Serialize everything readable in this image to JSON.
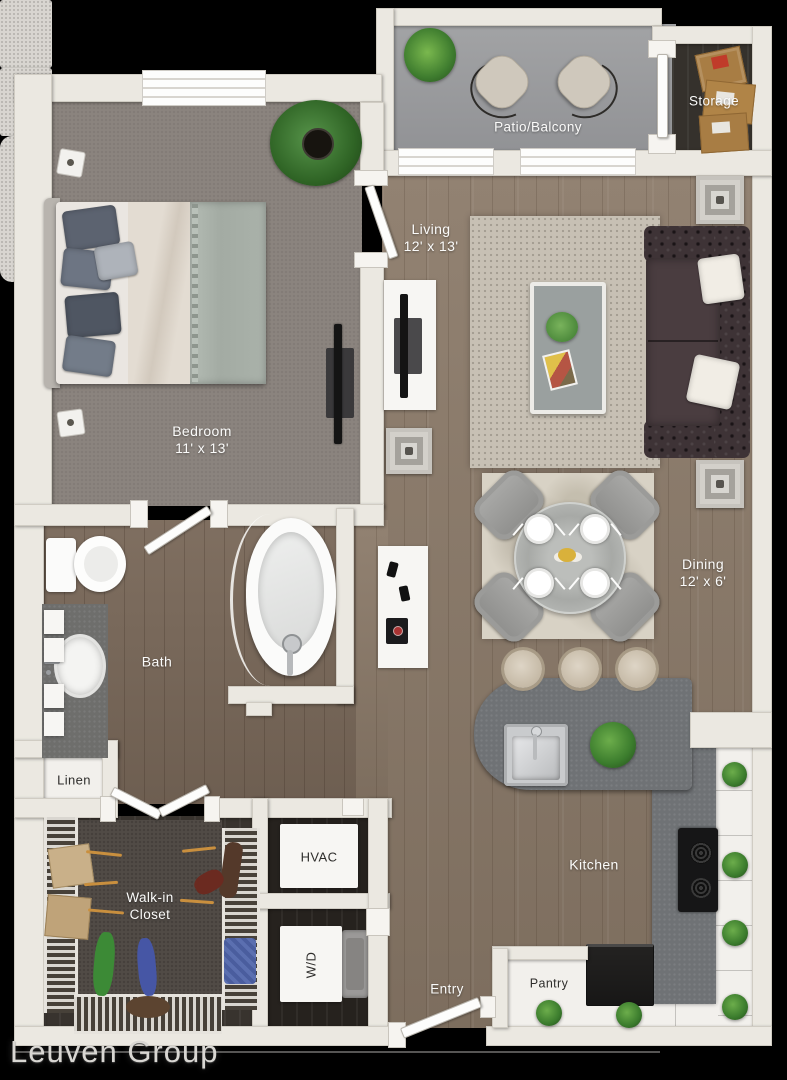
{
  "branding": {
    "watermark": "Leuven Group"
  },
  "rooms": {
    "patio": {
      "label": "Patio/Balcony"
    },
    "storage": {
      "label": "Storage"
    },
    "living": {
      "label": "Living",
      "dims": "12' x 13'"
    },
    "bedroom": {
      "label": "Bedroom",
      "dims": "11' x 13'"
    },
    "bath": {
      "label": "Bath"
    },
    "dining": {
      "label": "Dining",
      "dims": "12' x 6'"
    },
    "linen": {
      "label": "Linen"
    },
    "walk_in_closet": {
      "line1": "Walk-in",
      "line2": "Closet"
    },
    "hvac": {
      "label": "HVAC"
    },
    "washer_dryer": {
      "label": "W/D"
    },
    "entry": {
      "label": "Entry"
    },
    "pantry": {
      "label": "Pantry"
    },
    "kitchen": {
      "label": "Kitchen"
    }
  },
  "colors": {
    "background": "#000000",
    "wall": "#EBE8E1",
    "wood_floor": "#8B7A69",
    "bath_floor": "#7A695A",
    "bedroom_carpet": "#8B847E",
    "patio_concrete": "#9A9B9D",
    "counter_gray": "#6F7275",
    "rug_living": "#C7C0B4",
    "rug_dining": "#D8D2C5",
    "sofa": "#3E3336",
    "label_light": "#FBFBFA",
    "label_dark": "#2E2D2B"
  }
}
